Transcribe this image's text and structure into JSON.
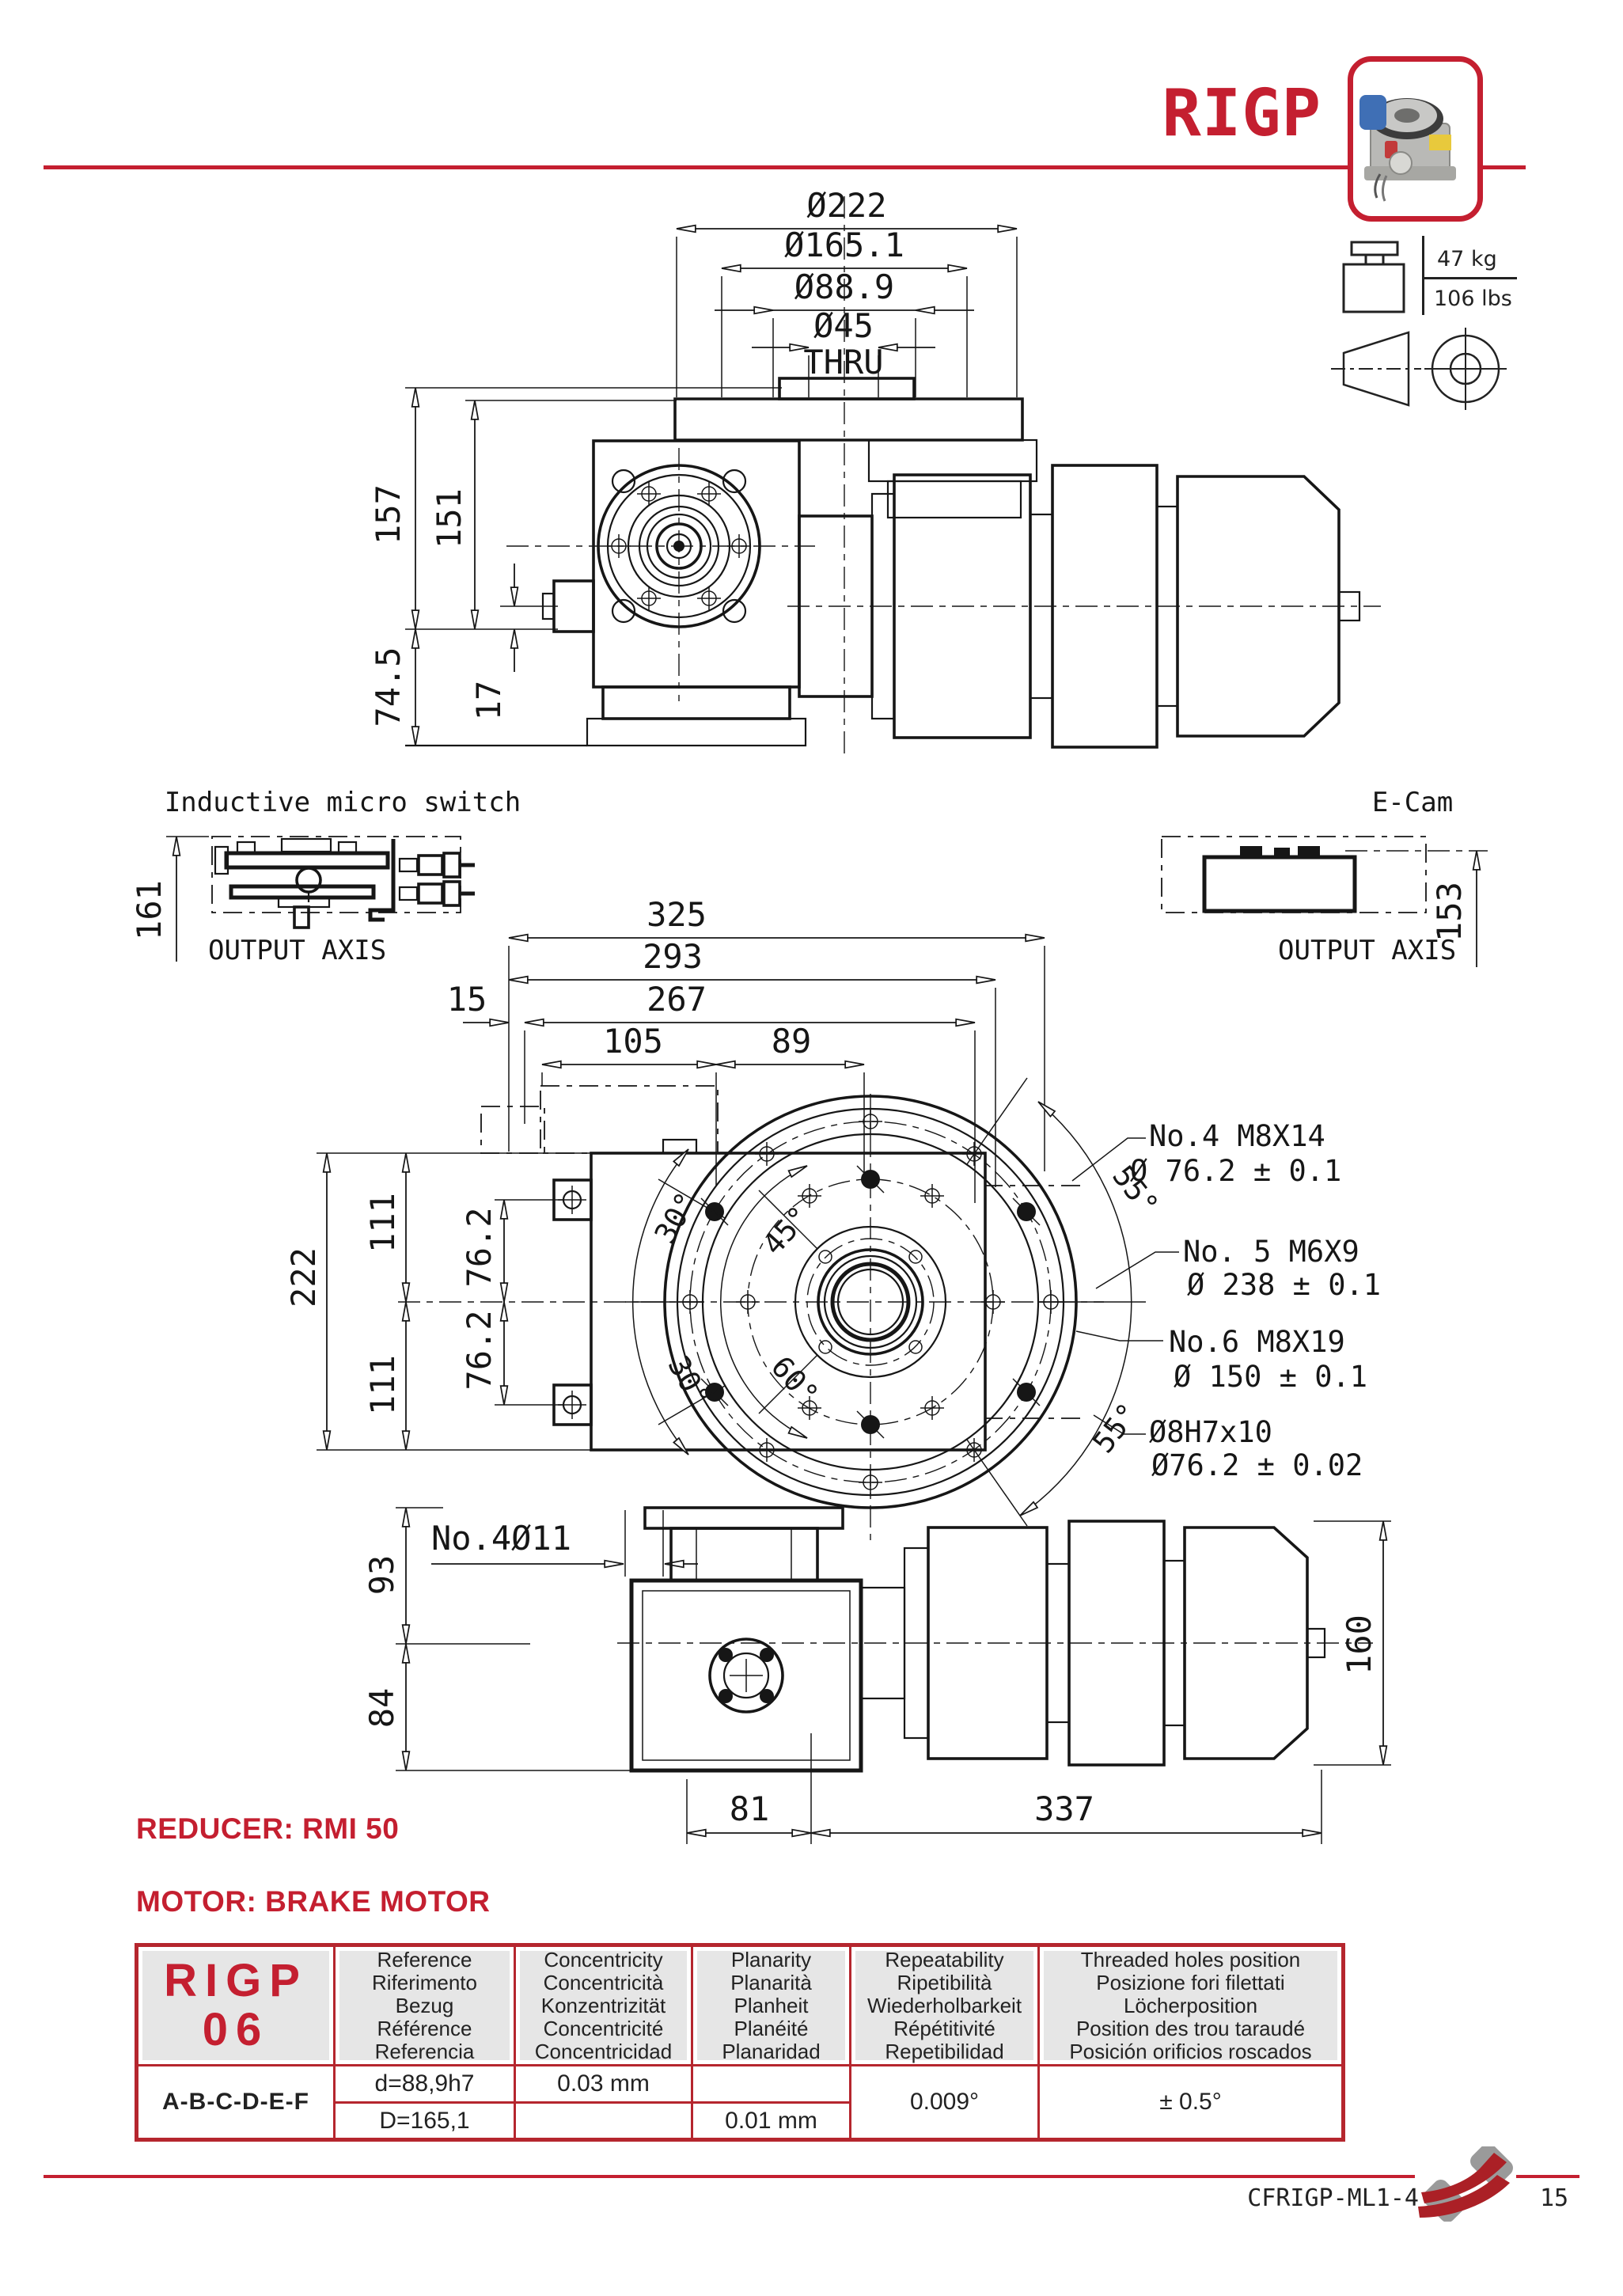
{
  "header": {
    "title": "RIGP"
  },
  "weight": {
    "kg": "47 kg",
    "lbs": "106 lbs"
  },
  "top_view": {
    "dims": {
      "d222": "Ø222",
      "d165": "Ø165.1",
      "d889": "Ø88.9",
      "d45": "Ø45",
      "thru": "THRU",
      "v157": "157",
      "v151": "151",
      "v745": "74.5",
      "v17": "17"
    }
  },
  "micro_switch": {
    "title": "Inductive micro switch",
    "dim": "161",
    "axis": "OUTPUT AXIS"
  },
  "ecam": {
    "title": "E-Cam",
    "dim": "153",
    "axis": "OUTPUT AXIS"
  },
  "front_view": {
    "dims": {
      "h325": "325",
      "h293": "293",
      "h267": "267",
      "h15": "15",
      "h105": "105",
      "h89": "89",
      "v222": "222",
      "v111a": "111",
      "v111b": "111",
      "v762a": "76.2",
      "v762b": "76.2",
      "v93": "93",
      "v84": "84",
      "no4d11": "No.4Ø11",
      "b81": "81",
      "b337": "337",
      "v160": "160"
    },
    "angles": {
      "a30a": "30°",
      "a30b": "30°",
      "a45": "45°",
      "a60": "60°",
      "a55a": "55°",
      "a55b": "55°"
    }
  },
  "callouts": {
    "c1_line1": "No.4  M8X14",
    "c1_line2": "Ø 76.2 ± 0.1",
    "c2_line1": "No. 5  M6X9",
    "c2_line2": "Ø 238 ± 0.1",
    "c3_line1": "No.6  M8X19",
    "c3_line2": "Ø 150 ± 0.1",
    "c4_line1": "Ø8H7x10",
    "c4_line2": "Ø76.2 ± 0.02"
  },
  "notes": {
    "reducer": "REDUCER: RMI 50",
    "motor": "MOTOR: BRAKE MOTOR"
  },
  "table": {
    "model_line1": "RIGP",
    "model_line2": "06",
    "row_label": "A-B-C-D-E-F",
    "headers": [
      {
        "lines": [
          "Reference",
          "Riferimento",
          "Bezug",
          "Référence",
          "Referencia"
        ]
      },
      {
        "lines": [
          "Concentricity",
          "Concentricità",
          "Konzentrizität",
          "Concentricité",
          "Concentricidad"
        ]
      },
      {
        "lines": [
          "Planarity",
          "Planarità",
          "Planheit",
          "Planéité",
          "Planaridad"
        ]
      },
      {
        "lines": [
          "Repeatability",
          "Ripetibilità",
          "Wiederholbarkeit",
          "Répétitivité",
          "Repetibilidad"
        ]
      },
      {
        "lines": [
          "Threaded holes position",
          "Posizione fori filettati",
          "Löcherposition",
          "Position des trou taraudé",
          "Posición orificios roscados"
        ]
      }
    ],
    "cells": {
      "ref1": "d=88,9h7",
      "conc1": "0.03 mm",
      "plan1": "",
      "ref2": "D=165,1",
      "conc2": "",
      "plan2": "0.01 mm",
      "repeat": "0.009°",
      "threaded": "± 0.5°"
    }
  },
  "footer": {
    "code": "CFRIGP-ML1-4",
    "page": "15"
  },
  "colors": {
    "accent": "#c41f30",
    "table_border": "#b5262e",
    "header_bg": "#e6e6e6",
    "ink": "#161616"
  }
}
